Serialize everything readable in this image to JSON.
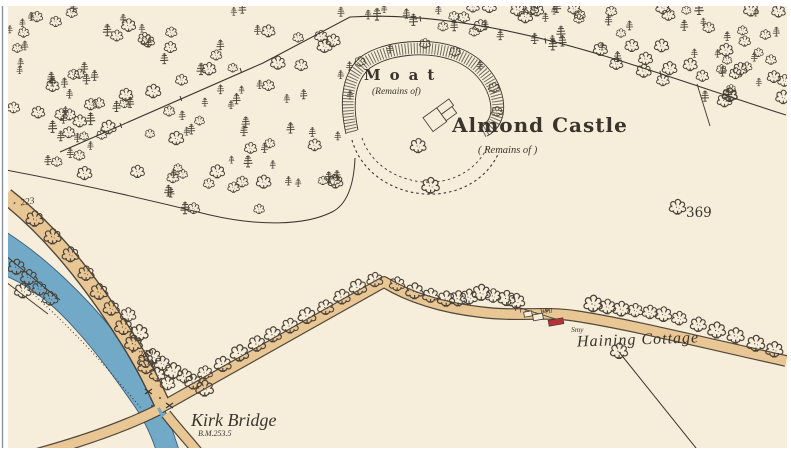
{
  "map": {
    "colors": {
      "paper": "#f6eeda",
      "ink": "#3c342c",
      "tree_ink": "#4a4137",
      "river_fill": "#72a9c6",
      "river_edge": "#3c5e79",
      "road_fill": "#e9c795",
      "road_edge": "#42382e",
      "building_red": "#b63238",
      "edge_line": "#8b949c"
    },
    "labels": {
      "moat": "Moat",
      "moat_remains": "(Remains of)",
      "castle": "Almond Castle",
      "castle_remains": "( Remains of )",
      "kirk_bridge": "Kirk Bridge",
      "kirk_bridge_benchmark": "B.M.253.5",
      "haining_cottage": "Haining Cottage",
      "well": "Well",
      "smithy": "Smy",
      "spot_369": "369",
      "spot_223": "223",
      "spot_239": "239"
    }
  }
}
